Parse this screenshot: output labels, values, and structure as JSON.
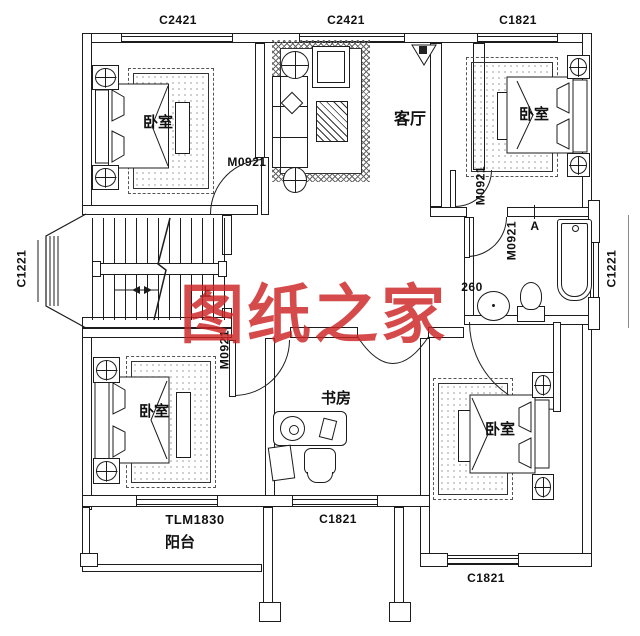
{
  "watermark": {
    "text": "图纸之家"
  },
  "room_labels": {
    "bedroom_top_left": "卧室",
    "living_room": "客厅",
    "bedroom_top_right": "卧室",
    "bedroom_bottom_left": "卧室",
    "study": "书房",
    "bedroom_bottom_right": "卧室",
    "balcony": "阳台"
  },
  "opening_labels": {
    "window_top_left": "C2421",
    "window_top_middle": "C2421",
    "window_top_right": "C1821",
    "window_left_bay": "C1221",
    "window_right_bath": "C1221",
    "door_bedroom_top_left": "M0921",
    "door_bedroom_top_right": "M0921",
    "door_bathroom": "M0921",
    "door_bedroom_bottom_left": "M0921",
    "balcony_door": "TLM1830",
    "window_study": "C1821",
    "window_bedroom_bottom_right": "C1821"
  },
  "annotations": {
    "bath_dim": "260",
    "elevation_marker": "A",
    "stairs_up": "上"
  },
  "colors": {
    "line": "#1c1c1c",
    "watermark": "#cc2323"
  }
}
